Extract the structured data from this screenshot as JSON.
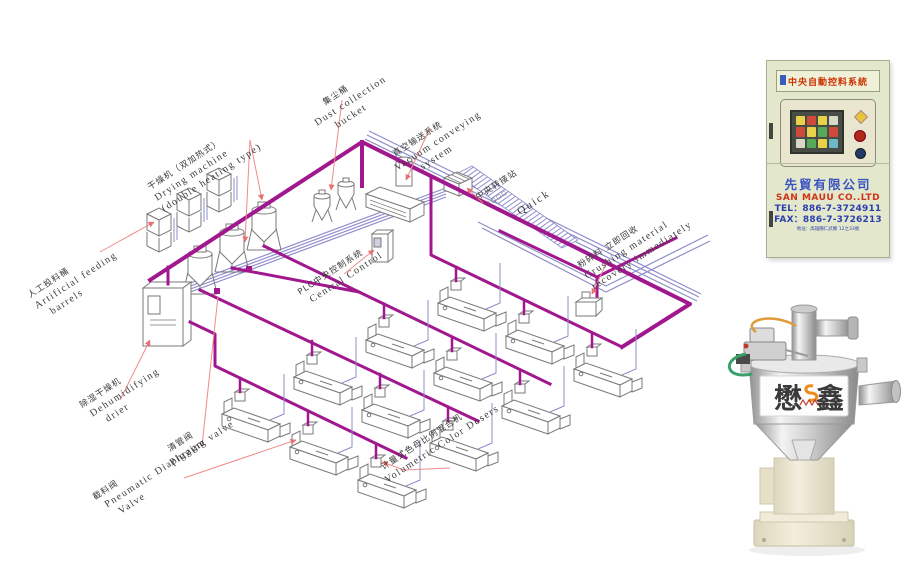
{
  "diagram": {
    "labels": [
      {
        "id": "feeding-barrels",
        "zh": "人工投料桶",
        "en1": "Artificial feeding",
        "en2": "barrels"
      },
      {
        "id": "drying-machine",
        "zh": "干燥机（双加热式）",
        "en1": "Drying machine",
        "en2": "(double heating type)"
      },
      {
        "id": "dust-collection",
        "zh": "集尘桶",
        "en1": "Dust collection",
        "en2": "bucket"
      },
      {
        "id": "vacuum-conveying",
        "zh": "真空输送系统",
        "en1": "Vacuum conveying",
        "en2": "system"
      },
      {
        "id": "central-transfer",
        "zh": "中央转接站",
        "en1": "□□□□",
        "en2": ""
      },
      {
        "id": "quick",
        "zh": "",
        "en1": "Quick",
        "en2": ""
      },
      {
        "id": "plc",
        "zh": "PLC中央控制系统",
        "en1": "Central Control",
        "en2": ""
      },
      {
        "id": "crushing",
        "zh": "粉碎料 立即回收",
        "en1": "Crushing material",
        "en2": "recovery immediately"
      },
      {
        "id": "dehumidifying",
        "zh": "除湿干燥机",
        "en1": "Dehumidifying",
        "en2": "drier"
      },
      {
        "id": "pigging",
        "zh": "清管阀",
        "en1": "Pigging valve",
        "en2": ""
      },
      {
        "id": "diaphragm-valve",
        "zh": "截料阀",
        "en1": "Pneumatic Diaphragm",
        "en2": "Valve"
      },
      {
        "id": "volumetric",
        "zh": "计量式色母比例混合机",
        "en1": "Volumetric Color Dosers",
        "en2": ""
      }
    ]
  },
  "cabinet": {
    "title": "中央自動控料系統",
    "company_zh": "先貿有限公司",
    "company_en": "SAN MAUU CO..LTD",
    "tel": "TEL：886-7-3724911",
    "fax": "FAX：886-7-3726213",
    "address": "地址：高雄縣仁武鄉 12之33號"
  },
  "product": {
    "brand_left": "懋",
    "brand_right": "鑫"
  },
  "colors": {
    "pipe_magenta": "#a1188e",
    "conveyor_blue": "#8d8dcb",
    "leader_red": "#ef8a8a",
    "cabinet_blue": "#2b3fae",
    "cabinet_red": "#d03318"
  }
}
